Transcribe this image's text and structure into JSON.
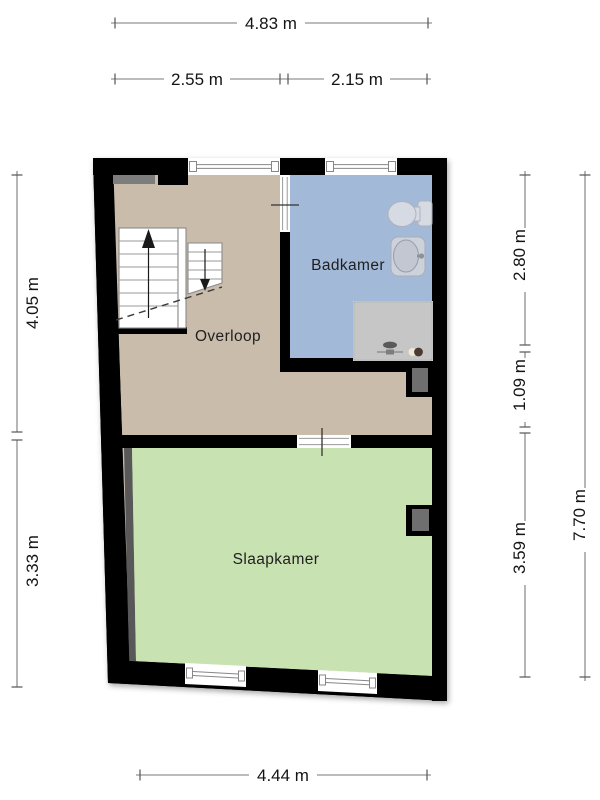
{
  "page": {
    "background": "#ffffff"
  },
  "plan": {
    "wall_color": "#000000",
    "rooms": [
      {
        "id": "overloop",
        "label": "Overloop",
        "floor_color": "#cabcab"
      },
      {
        "id": "badkamer",
        "label": "Badkamer",
        "floor_color": "#a3b9d8"
      },
      {
        "id": "slaapkamer",
        "label": "Slaapkamer",
        "floor_color": "#c8e2b2"
      }
    ],
    "fixtures": [
      {
        "id": "toilet"
      },
      {
        "id": "sink"
      },
      {
        "id": "shower"
      },
      {
        "id": "staircase-up"
      },
      {
        "id": "staircase-down"
      }
    ]
  },
  "dimensions": {
    "top": [
      {
        "id": "total-width",
        "label": "4.83 m"
      },
      {
        "id": "overloop-width",
        "label": "2.55 m"
      },
      {
        "id": "badkamer-width",
        "label": "2.15 m"
      }
    ],
    "left": [
      {
        "id": "overloop-depth",
        "label": "4.05 m"
      },
      {
        "id": "slaapkamer-depth-left",
        "label": "3.33 m"
      }
    ],
    "right": [
      {
        "id": "badkamer-depth",
        "label": "2.80 m"
      },
      {
        "id": "hall-strip-depth",
        "label": "1.09 m"
      },
      {
        "id": "slaapkamer-depth",
        "label": "3.59 m"
      },
      {
        "id": "total-depth",
        "label": "7.70 m"
      }
    ],
    "bottom": [
      {
        "id": "slaapkamer-width",
        "label": "4.44 m"
      }
    ]
  }
}
